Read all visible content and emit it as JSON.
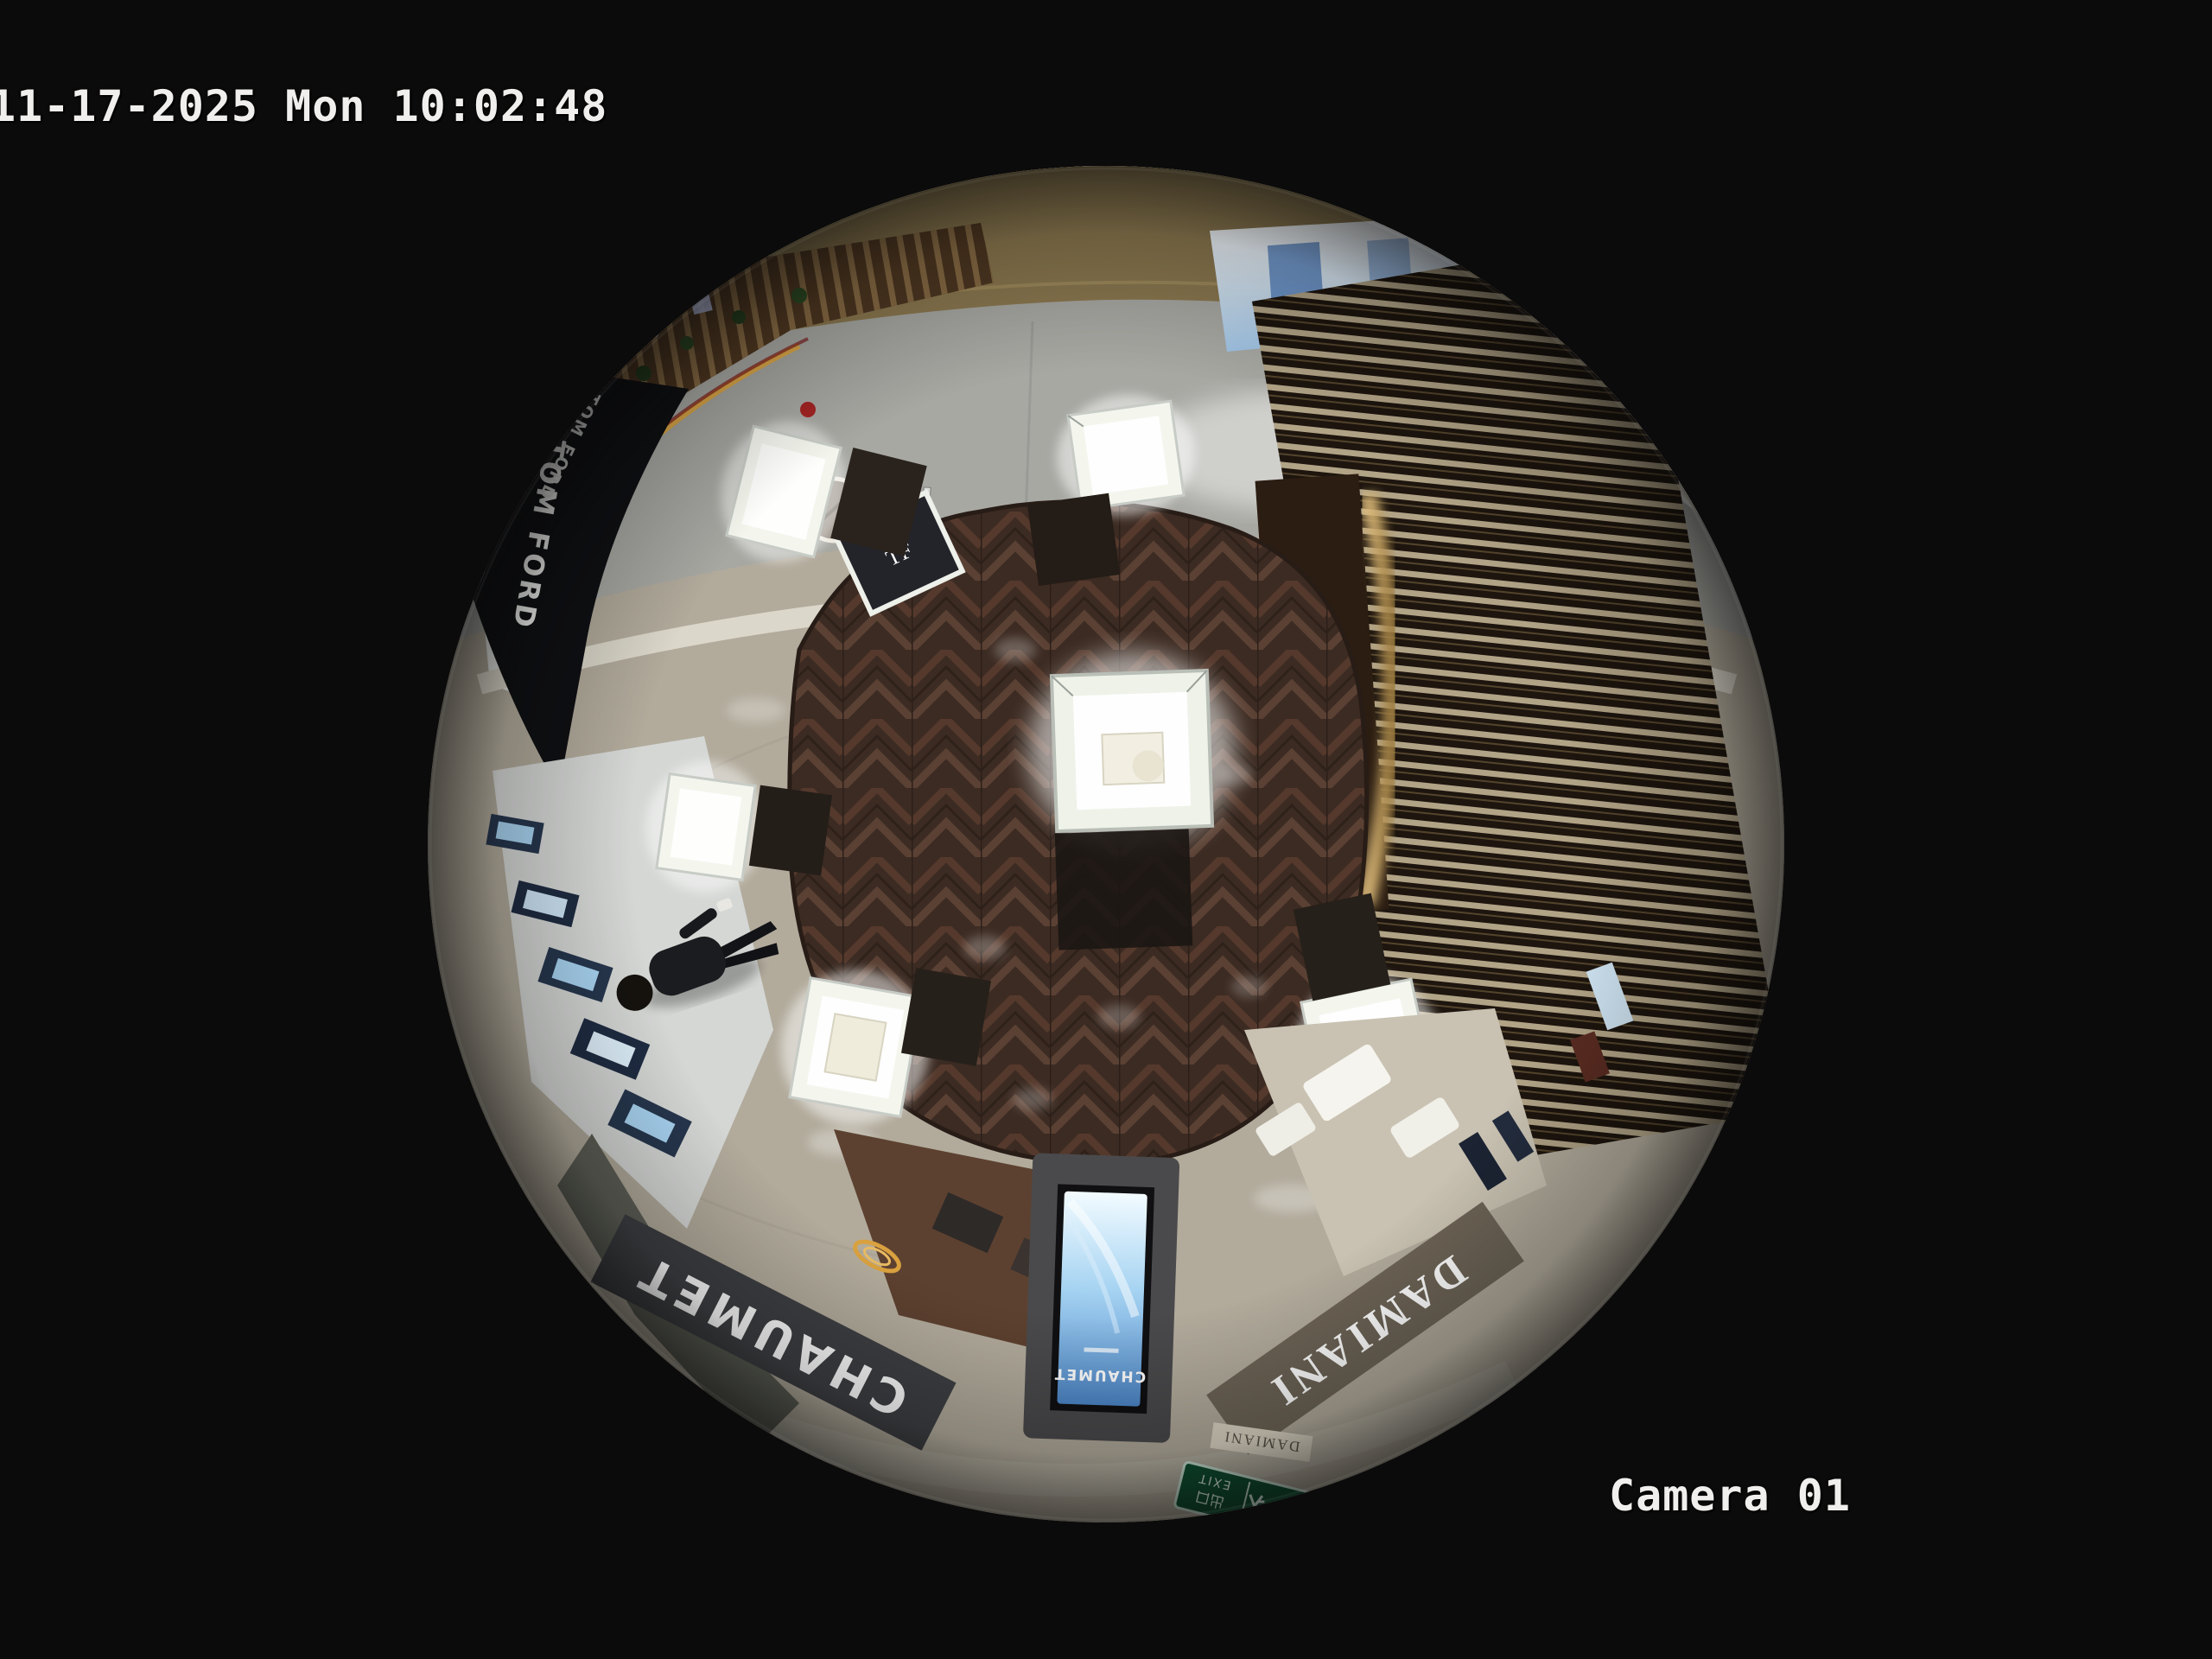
{
  "overlay": {
    "timestamp": "11-17-2025 Mon 10:02:48",
    "camera_label": "Camera 01"
  },
  "scene": {
    "signs": {
      "tom_ford_upper": "TOM FORD",
      "tom_ford": "TOM FORD",
      "tf_monogram": "TF",
      "tory_burch": "TORY BURCH",
      "chaumet": "CHAUMET",
      "chaumet_screen": "CHAUMET",
      "damiani": "DAMIANI",
      "damiani_small": "DAMIANI",
      "exit_cjk": "出口",
      "exit_en": "EXIT",
      "exit_arrow": "←"
    },
    "colors": {
      "background": "#0b0b0b",
      "overlay_text": "#f0efed",
      "tile_floor": "#b2ab9c",
      "marble_floor": "#a8a8a3",
      "wood_floor": "#3f2d24",
      "gold_wall": "#8c7950",
      "balcony_wood": "#5a3f28",
      "slat_light": "#d6c7a4",
      "screen_blue": "#8cc6ee",
      "exit_green": "#0f5132",
      "chaumet_band": "#3f4044",
      "damiani_band": "#6d6456",
      "sign_white": "#ffffff",
      "case_glow": "#f4f6ee"
    }
  }
}
